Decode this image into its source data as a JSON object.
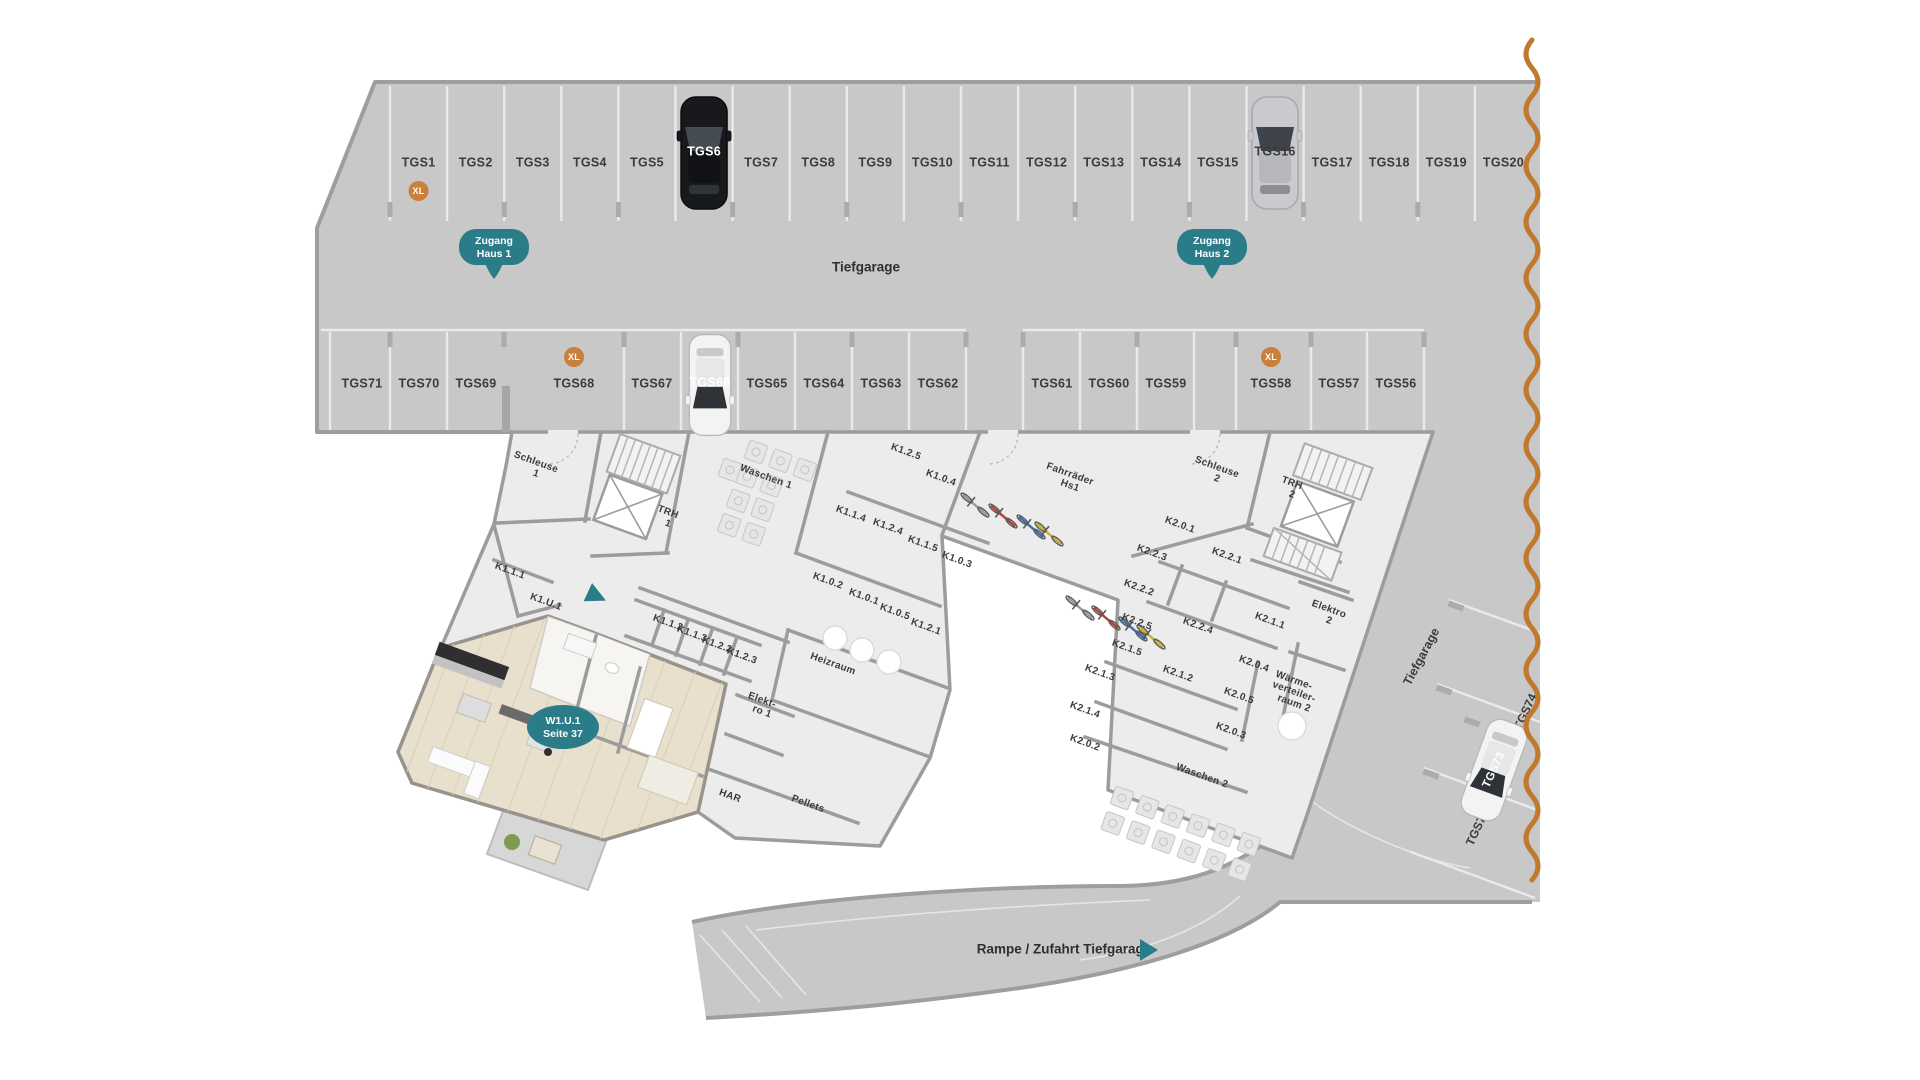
{
  "palette": {
    "teal": "#2a7c88",
    "orange_xl": "#c9803b",
    "wave_orange": "#bf7a2e",
    "garage_gray": "#c8c8c8",
    "floor_gray": "#ececec",
    "wall_gray": "#9c9c9c",
    "wood": "#e8dfcc",
    "label_text": "#3b3b3b"
  },
  "garage": {
    "aisle_label": "Tiefgarage",
    "xl_label": "XL",
    "access_badges": [
      {
        "line1": "Zugang",
        "line2": "Haus 1"
      },
      {
        "line1": "Zugang",
        "line2": "Haus 2"
      }
    ],
    "row1": {
      "ids": [
        "TGS1",
        "TGS2",
        "TGS3",
        "TGS4",
        "TGS5",
        "TGS6",
        "TGS7",
        "TGS8",
        "TGS9",
        "TGS10",
        "TGS11",
        "TGS12",
        "TGS13",
        "TGS14",
        "TGS15",
        "TGS16",
        "TGS17",
        "TGS18",
        "TGS19",
        "TGS20"
      ],
      "xl_ids": [
        "TGS1"
      ],
      "cars": [
        {
          "id": "TGS6",
          "style": "black"
        },
        {
          "id": "TGS16",
          "style": "silver"
        }
      ]
    },
    "row2": {
      "ids": [
        "TGS71",
        "TGS70",
        "TGS69",
        "TGS68",
        "TGS67",
        "TGS66",
        "TGS65",
        "TGS64",
        "TGS63",
        "TGS62",
        "TGS61",
        "TGS60",
        "TGS59",
        "TGS58",
        "TGS57",
        "TGS56"
      ],
      "centers": [
        362,
        419,
        476,
        574,
        652,
        710,
        767,
        824,
        881,
        938,
        1052,
        1109,
        1166,
        1271,
        1339,
        1396
      ],
      "xl_ids": [
        "TGS68",
        "TGS58"
      ],
      "cars": [
        {
          "id": "TGS66",
          "style": "white"
        }
      ]
    }
  },
  "rooms": [
    {
      "lines": [
        "Schleuse",
        "1"
      ],
      "x": 536,
      "y": 468
    },
    {
      "lines": [
        "TRH",
        "1"
      ],
      "x": 668,
      "y": 518
    },
    {
      "lines": [
        "Waschen 1"
      ],
      "x": 766,
      "y": 477
    },
    {
      "lines": [
        "K1.2.5"
      ],
      "x": 906,
      "y": 452
    },
    {
      "lines": [
        "K1.0.4"
      ],
      "x": 941,
      "y": 478
    },
    {
      "lines": [
        "K1.1.4"
      ],
      "x": 851,
      "y": 514
    },
    {
      "lines": [
        "K1.2.4"
      ],
      "x": 888,
      "y": 527
    },
    {
      "lines": [
        "K1.1.5"
      ],
      "x": 923,
      "y": 544
    },
    {
      "lines": [
        "K1.0.3"
      ],
      "x": 957,
      "y": 560
    },
    {
      "lines": [
        "Fahrräder",
        "Hs1"
      ],
      "x": 1070,
      "y": 480
    },
    {
      "lines": [
        "K1.1.1"
      ],
      "x": 510,
      "y": 571
    },
    {
      "lines": [
        "K1.U.1"
      ],
      "x": 546,
      "y": 602
    },
    {
      "lines": [
        "K1.1.2"
      ],
      "x": 668,
      "y": 623
    },
    {
      "lines": [
        "K1.1.3"
      ],
      "x": 692,
      "y": 634
    },
    {
      "lines": [
        "K1.2.2"
      ],
      "x": 717,
      "y": 645
    },
    {
      "lines": [
        "K1.2.3"
      ],
      "x": 742,
      "y": 656
    },
    {
      "lines": [
        "K1.0.2"
      ],
      "x": 828,
      "y": 581
    },
    {
      "lines": [
        "K1.0.1"
      ],
      "x": 864,
      "y": 597
    },
    {
      "lines": [
        "K1.0.5"
      ],
      "x": 895,
      "y": 612
    },
    {
      "lines": [
        "K1.2.1"
      ],
      "x": 926,
      "y": 627
    },
    {
      "lines": [
        "Heizraum"
      ],
      "x": 833,
      "y": 664
    },
    {
      "lines": [
        "Elekt-",
        "ro 1"
      ],
      "x": 762,
      "y": 706
    },
    {
      "lines": [
        "HAR"
      ],
      "x": 730,
      "y": 796
    },
    {
      "lines": [
        "Pellets"
      ],
      "x": 808,
      "y": 804
    },
    {
      "lines": [
        "Schleuse",
        "2"
      ],
      "x": 1217,
      "y": 473
    },
    {
      "lines": [
        "TRH",
        "2"
      ],
      "x": 1292,
      "y": 489
    },
    {
      "lines": [
        "K2.0.1"
      ],
      "x": 1180,
      "y": 525
    },
    {
      "lines": [
        "K2.2.3"
      ],
      "x": 1152,
      "y": 553
    },
    {
      "lines": [
        "K2.2.1"
      ],
      "x": 1227,
      "y": 556
    },
    {
      "lines": [
        "K2.2.2"
      ],
      "x": 1139,
      "y": 588
    },
    {
      "lines": [
        "K2.2.5"
      ],
      "x": 1137,
      "y": 622
    },
    {
      "lines": [
        "K2.2.4"
      ],
      "x": 1198,
      "y": 626
    },
    {
      "lines": [
        "K2.1.1"
      ],
      "x": 1270,
      "y": 621
    },
    {
      "lines": [
        "Elektro",
        "2"
      ],
      "x": 1329,
      "y": 615
    },
    {
      "lines": [
        "K2.1.5"
      ],
      "x": 1127,
      "y": 648
    },
    {
      "lines": [
        "K2.1.3"
      ],
      "x": 1100,
      "y": 673
    },
    {
      "lines": [
        "K2.1.2"
      ],
      "x": 1178,
      "y": 674
    },
    {
      "lines": [
        "K2.0.4"
      ],
      "x": 1254,
      "y": 664
    },
    {
      "lines": [
        "K2.0.5"
      ],
      "x": 1239,
      "y": 696
    },
    {
      "lines": [
        "Wärme-",
        "verteiler-",
        "raum 2"
      ],
      "x": 1294,
      "y": 692
    },
    {
      "lines": [
        "K2.1.4"
      ],
      "x": 1085,
      "y": 710
    },
    {
      "lines": [
        "K2.0.2"
      ],
      "x": 1085,
      "y": 743
    },
    {
      "lines": [
        "K2.0.3"
      ],
      "x": 1231,
      "y": 731
    },
    {
      "lines": [
        "Waschen 2"
      ],
      "x": 1202,
      "y": 776
    }
  ],
  "corridor": {
    "garage_label": "Tiefgarage",
    "spot_empty": "TGS72",
    "spot_car": "TGS73",
    "spot_partial": "TGS74"
  },
  "ramp": {
    "label": "Rampe / Zufahrt Tiefgarage"
  },
  "apartment": {
    "badge": {
      "line1": "W1.U.1",
      "line2": "Seite 37"
    }
  }
}
